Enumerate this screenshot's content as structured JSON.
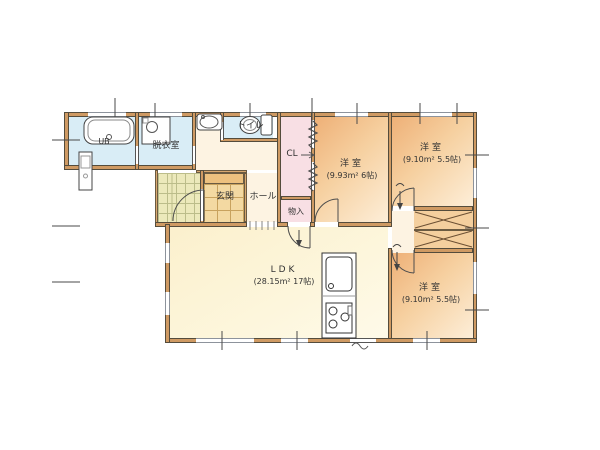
{
  "plan": {
    "rooms": {
      "ub": {
        "label": "UB"
      },
      "dressing": {
        "label": "脱衣室"
      },
      "toilet": {
        "label": "トイレ"
      },
      "closet": {
        "label": "CL"
      },
      "bedroom1": {
        "label": "洋室",
        "area": "(9.93m² 6帖)"
      },
      "bedroom2": {
        "label": "洋室",
        "area": "(9.10m² 5.5帖)"
      },
      "bedroom3": {
        "label": "洋室",
        "area": "(9.10m² 5.5帖)"
      },
      "genkan": {
        "label": "玄関"
      },
      "hall": {
        "label": "ホール"
      },
      "storage": {
        "label": "物入"
      },
      "ldk": {
        "label": "LDK",
        "area": "(28.15m² 17帖)"
      }
    },
    "fixtures": {
      "bathtub": "bathtub-icon",
      "vanity": "vanity-icon",
      "washing_machine": "washing-machine-icon",
      "washbasin": "washbasin-icon",
      "toilet": "toilet-icon",
      "kitchen": "kitchen-counter-icon"
    },
    "colors": {
      "wall_fill": "#cf9a63",
      "wall_line": "#544c3c",
      "wet_floor": "#d9edf6",
      "bedroom_floor_dark": "#eeb077",
      "bedroom_floor_light": "#fdeed8",
      "ldk_floor": "#fbf3d7",
      "hall_floor": "#fdf3e2",
      "closet_floor": "#f8dfe4",
      "genkan_tile": "#f3d9a2",
      "porch_tile": "#ece9bb",
      "window_line": "#8d939c"
    }
  }
}
